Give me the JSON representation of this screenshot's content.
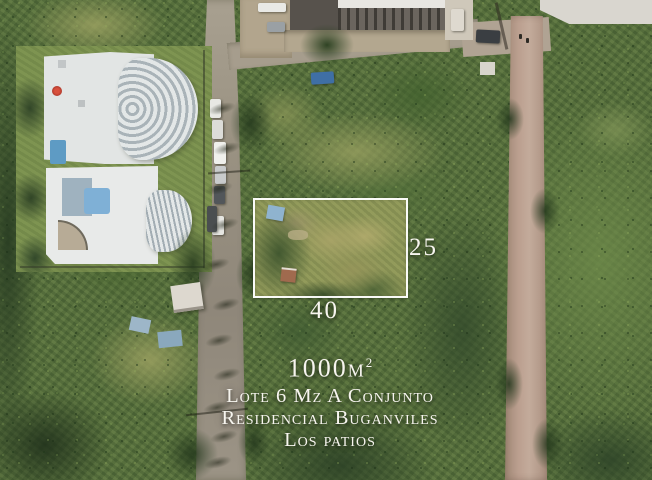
{
  "annotation": {
    "area_value": "1000m",
    "area_exponent": "2",
    "title_line1": "Lote 6 Mz A Conjunto",
    "title_line2": "Residencial Buganviles",
    "title_line3": "Los patios",
    "depth_label": "25",
    "width_label": "40",
    "boundary_color": "#ffffff",
    "text_color": "#f7f5ef"
  }
}
